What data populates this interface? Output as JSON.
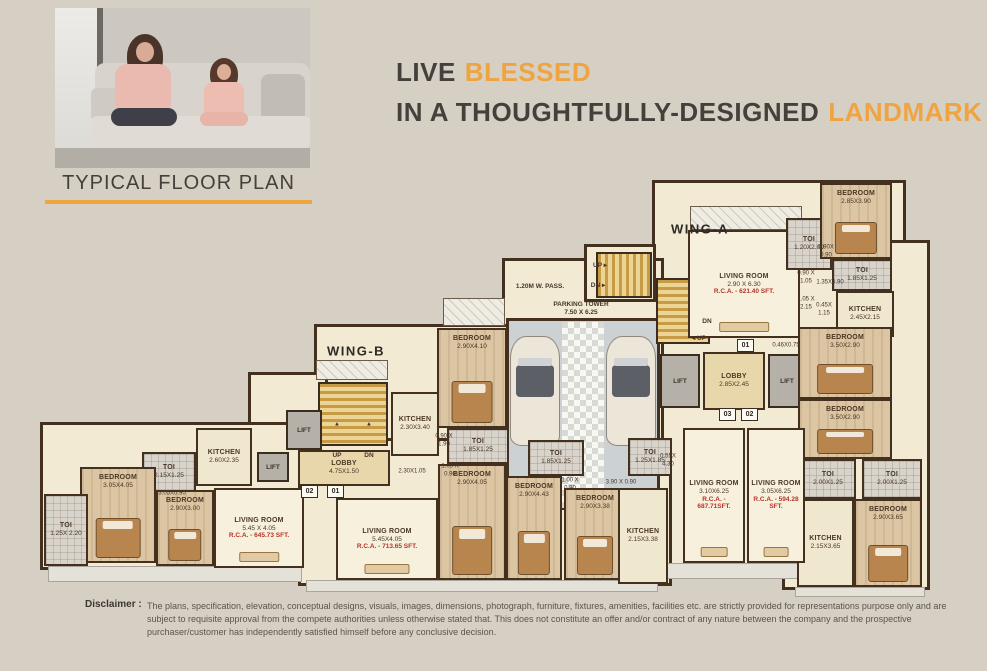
{
  "header": {
    "headline": {
      "l1_dark": "LIVE",
      "l1_accent": "BLESSED",
      "l2_dark": "IN A THOUGHTFULLY-DESIGNED",
      "l2_accent": "LANDMARK"
    },
    "section_title": "TYPICAL FLOOR PLAN"
  },
  "colors": {
    "accent": "#efa440",
    "background": "#d6cfc4",
    "wall": "#43301f",
    "rca_red": "#b5342b"
  },
  "plan": {
    "lift_label": "LIFT",
    "wing_labels": [
      {
        "t": "WING-A",
        "x": 700,
        "y": 229
      },
      {
        "t": "WING-B",
        "x": 356,
        "y": 351
      }
    ],
    "base": [
      {
        "x": 652,
        "y": 180,
        "w": 254,
        "h": 150
      },
      {
        "x": 782,
        "y": 240,
        "w": 148,
        "h": 350
      },
      {
        "x": 652,
        "y": 330,
        "w": 154,
        "h": 237
      },
      {
        "x": 502,
        "y": 258,
        "w": 162,
        "h": 254
      },
      {
        "x": 584,
        "y": 244,
        "w": 72,
        "h": 58
      },
      {
        "x": 314,
        "y": 324,
        "w": 198,
        "h": 164
      },
      {
        "x": 248,
        "y": 372,
        "w": 80,
        "h": 116
      },
      {
        "x": 40,
        "y": 422,
        "w": 270,
        "h": 148
      },
      {
        "x": 298,
        "y": 438,
        "w": 374,
        "h": 148
      }
    ],
    "decks": [
      {
        "x": 48,
        "y": 566,
        "w": 254,
        "h": 16,
        "v": "plain"
      },
      {
        "x": 306,
        "y": 580,
        "w": 352,
        "h": 12,
        "v": "plain"
      },
      {
        "x": 658,
        "y": 563,
        "w": 148,
        "h": 16,
        "v": "plain"
      },
      {
        "x": 795,
        "y": 587,
        "w": 130,
        "h": 10,
        "v": "plain"
      },
      {
        "x": 690,
        "y": 206,
        "w": 112,
        "h": 24,
        "v": "hatch"
      },
      {
        "x": 443,
        "y": 298,
        "w": 62,
        "h": 28,
        "v": "hatch"
      },
      {
        "x": 316,
        "y": 360,
        "w": 72,
        "h": 20,
        "v": "hatch"
      }
    ],
    "parking": {
      "floor": {
        "x": 506,
        "y": 318,
        "w": 154,
        "h": 192
      },
      "checker": {
        "x": 562,
        "y": 322,
        "w": 42,
        "h": 186
      },
      "cars": [
        {
          "x": 510,
          "y": 336,
          "w": 50,
          "h": 110
        },
        {
          "x": 606,
          "y": 336,
          "w": 50,
          "h": 110
        }
      ]
    },
    "stairs": [
      {
        "x": 596,
        "y": 252,
        "w": 56,
        "h": 46,
        "o": "h"
      },
      {
        "x": 656,
        "y": 278,
        "w": 54,
        "h": 66,
        "o": "v"
      },
      {
        "x": 318,
        "y": 382,
        "w": 70,
        "h": 64,
        "o": "v"
      }
    ],
    "lifts": [
      {
        "x": 660,
        "y": 354,
        "w": 40,
        "h": 54
      },
      {
        "x": 768,
        "y": 354,
        "w": 38,
        "h": 54
      },
      {
        "x": 286,
        "y": 410,
        "w": 36,
        "h": 40
      },
      {
        "x": 257,
        "y": 452,
        "w": 32,
        "h": 30
      }
    ],
    "rooms": [
      {
        "name": "LIVING ROOM",
        "dims": "2.90 X 6.30",
        "rca": "R.C.A. - 621.40 SFT.",
        "type": "living",
        "x": 688,
        "y": 230,
        "w": 112,
        "h": 108
      },
      {
        "name": "TOI",
        "dims": "1.20X2.00",
        "type": "toi",
        "x": 786,
        "y": 218,
        "w": 46,
        "h": 52
      },
      {
        "name": "BEDROOM",
        "dims": "2.85X3.90",
        "type": "bedroom",
        "x": 820,
        "y": 183,
        "w": 72,
        "h": 76
      },
      {
        "name": "TOI",
        "dims": "1.85X1.25",
        "type": "toi",
        "x": 832,
        "y": 259,
        "w": 60,
        "h": 32
      },
      {
        "name": "KITCHEN",
        "dims": "2.45X2.15",
        "type": "kitchen",
        "x": 836,
        "y": 291,
        "w": 58,
        "h": 46
      },
      {
        "name": "BEDROOM",
        "dims": "3.50X2.90",
        "type": "bedroom",
        "x": 798,
        "y": 327,
        "w": 94,
        "h": 72
      },
      {
        "name": "BEDROOM",
        "dims": "3.50X2.90",
        "type": "bedroom",
        "x": 798,
        "y": 399,
        "w": 94,
        "h": 60
      },
      {
        "name": "TOI",
        "dims": "2.00X1.25",
        "type": "toi",
        "x": 800,
        "y": 459,
        "w": 56,
        "h": 40
      },
      {
        "name": "TOI",
        "dims": "2.00X1.25",
        "type": "toi",
        "x": 862,
        "y": 459,
        "w": 60,
        "h": 40
      },
      {
        "name": "BEDROOM",
        "dims": "2.90X3.65",
        "type": "bedroom",
        "x": 854,
        "y": 499,
        "w": 68,
        "h": 88
      },
      {
        "name": "KITCHEN",
        "dims": "2.15X3.65",
        "type": "kitchen",
        "x": 797,
        "y": 499,
        "w": 57,
        "h": 88
      },
      {
        "name": "LOBBY",
        "dims": "2.85X2.45",
        "type": "lobby",
        "x": 703,
        "y": 352,
        "w": 62,
        "h": 58
      },
      {
        "name": "LIVING ROOM",
        "dims": "3.10X6.25",
        "rca": "R.C.A. - 687.71SFT.",
        "type": "living",
        "x": 683,
        "y": 428,
        "w": 62,
        "h": 135
      },
      {
        "name": "LIVING ROOM",
        "dims": "3.05X6.25",
        "rca": "R.C.A. - 594.28 SFT.",
        "type": "living",
        "x": 747,
        "y": 428,
        "w": 58,
        "h": 135
      },
      {
        "name": "BEDROOM",
        "dims": "2.90X4.10",
        "type": "bedroom",
        "x": 437,
        "y": 328,
        "w": 70,
        "h": 100
      },
      {
        "name": "TOI",
        "dims": "1.85X1.25",
        "type": "toi",
        "x": 447,
        "y": 428,
        "w": 62,
        "h": 36
      },
      {
        "name": "KITCHEN",
        "dims": "2.30X3.40",
        "type": "kitchen",
        "x": 391,
        "y": 392,
        "w": 48,
        "h": 64
      },
      {
        "name": "LOBBY",
        "dims": "4.75X1.50",
        "type": "lobby",
        "x": 298,
        "y": 450,
        "w": 92,
        "h": 36
      },
      {
        "name": "KITCHEN",
        "dims": "2.60X2.35",
        "type": "kitchen",
        "x": 196,
        "y": 428,
        "w": 56,
        "h": 58
      },
      {
        "name": "TOI",
        "dims": "2.15X1.25",
        "type": "toi",
        "x": 142,
        "y": 452,
        "w": 54,
        "h": 40
      },
      {
        "name": "BEDROOM",
        "dims": "3.05X4.05",
        "type": "bedroom",
        "x": 80,
        "y": 467,
        "w": 76,
        "h": 96
      },
      {
        "name": "TOI",
        "dims": "1.25X 2.20",
        "type": "toi",
        "x": 44,
        "y": 494,
        "w": 44,
        "h": 72
      },
      {
        "name": "BEDROOM",
        "dims": "2.90X3.00",
        "type": "bedroom",
        "x": 156,
        "y": 490,
        "w": 58,
        "h": 76
      },
      {
        "name": "LIVING ROOM",
        "dims": "5.45 X 4.05",
        "rca": "R.C.A. - 645.73 SFT.",
        "type": "living",
        "x": 214,
        "y": 488,
        "w": 90,
        "h": 80
      },
      {
        "name": "LIVING ROOM",
        "dims": "5.45X4.05",
        "rca": "R.C.A. - 713.65 SFT.",
        "type": "living",
        "x": 336,
        "y": 498,
        "w": 102,
        "h": 82
      },
      {
        "name": "BEDROOM",
        "dims": "2.90X4.05",
        "type": "bedroom",
        "x": 438,
        "y": 464,
        "w": 68,
        "h": 116
      },
      {
        "name": "BEDROOM",
        "dims": "2.90X4.43",
        "type": "bedroom",
        "x": 506,
        "y": 476,
        "w": 56,
        "h": 104
      },
      {
        "name": "TOI",
        "dims": "1.85X1.25",
        "type": "toi",
        "x": 528,
        "y": 440,
        "w": 56,
        "h": 36
      },
      {
        "name": "BEDROOM",
        "dims": "2.90X3.38",
        "type": "bedroom",
        "x": 564,
        "y": 488,
        "w": 62,
        "h": 92
      },
      {
        "name": "KITCHEN",
        "dims": "2.15X3.38",
        "type": "kitchen",
        "x": 618,
        "y": 488,
        "w": 50,
        "h": 96
      },
      {
        "name": "TOI",
        "dims": "1.25X1.85",
        "type": "toi",
        "x": 628,
        "y": 438,
        "w": 44,
        "h": 38
      }
    ],
    "labels": [
      {
        "t": "1.20M W. PASS.",
        "x": 540,
        "y": 287,
        "b": 1
      },
      {
        "t": "PARKING TOWER\n7.50 X 6.25",
        "x": 581,
        "y": 309,
        "b": 1
      },
      {
        "t": "0.90X\n0.90",
        "x": 826,
        "y": 252
      },
      {
        "t": "0.90 X\n1.05",
        "x": 806,
        "y": 278
      },
      {
        "t": "1.35X0.90",
        "x": 830,
        "y": 283
      },
      {
        "t": "1.05 X\n2.15",
        "x": 806,
        "y": 304
      },
      {
        "t": "0.45X\n1.15",
        "x": 824,
        "y": 310
      },
      {
        "t": "0.46X0.75",
        "x": 786,
        "y": 346
      },
      {
        "t": "UP ▸",
        "x": 600,
        "y": 266,
        "b": 1
      },
      {
        "t": "DN ▸",
        "x": 598,
        "y": 286,
        "b": 1
      },
      {
        "t": "DN",
        "x": 707,
        "y": 322,
        "b": 1
      },
      {
        "t": "◂ UP",
        "x": 699,
        "y": 339,
        "b": 1
      },
      {
        "t": "▲",
        "x": 337,
        "y": 425
      },
      {
        "t": "▲",
        "x": 369,
        "y": 425
      },
      {
        "t": "UP",
        "x": 337,
        "y": 456,
        "b": 1
      },
      {
        "t": "DN",
        "x": 369,
        "y": 456,
        "b": 1
      },
      {
        "t": "0.90 X\n1.90",
        "x": 444,
        "y": 441
      },
      {
        "t": "1.05 X\n0.90",
        "x": 450,
        "y": 471
      },
      {
        "t": "2.30X1.05",
        "x": 412,
        "y": 472
      },
      {
        "t": "3.05X0.90",
        "x": 172,
        "y": 494
      },
      {
        "t": "1.00 X\n0.90",
        "x": 570,
        "y": 485
      },
      {
        "t": "3.90 X 0.90",
        "x": 621,
        "y": 483
      },
      {
        "t": "0.55X\n4.30",
        "x": 668,
        "y": 461
      }
    ],
    "plates": [
      {
        "t": "01",
        "x": 737,
        "y": 339
      },
      {
        "t": "03",
        "x": 719,
        "y": 408
      },
      {
        "t": "02",
        "x": 741,
        "y": 408
      },
      {
        "t": "02",
        "x": 301,
        "y": 485
      },
      {
        "t": "01",
        "x": 327,
        "y": 485
      }
    ]
  },
  "disclaimer": {
    "label": "Disclaimer :",
    "text": "The plans, specification, elevation, conceptual designs, visuals, images, dimensions, photograph, furniture, fixtures, amenities, facilities etc. are strictly provided for representations purpose only and are subject to requisite approval from the compete authorities unless otherwise stated that. This does not constitute an offer and/or contract of any nature between the company and the prospective purchaser/customer has independently satisfied himself before any conclusive decision."
  }
}
